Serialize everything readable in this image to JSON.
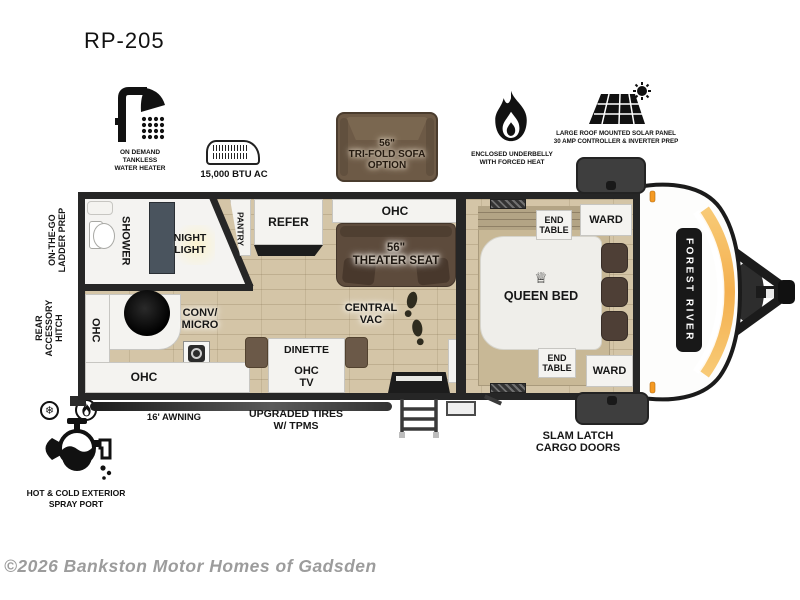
{
  "title": "RP-205",
  "features": {
    "water_heater": "ON DEMAND\nTANKLESS\nWATER HEATER",
    "ac": "15,000 BTU AC",
    "sofa": "56\"\nTRI-FOLD SOFA\nOPTION",
    "underbelly": "ENCLOSED UNDERBELLY\nWITH FORCED HEAT",
    "solar": "LARGE ROOF MOUNTED SOLAR PANEL\n30 AMP CONTROLLER & INVERTER PREP"
  },
  "plan": {
    "shower": "SHOWER",
    "night_light": "NIGHT\nLIGHT",
    "pantry": "PANTRY",
    "refer": "REFER",
    "ohc_galley": "OHC",
    "theater_seat": "56\"\nTHEATER SEAT",
    "central_vac": "CENTRAL\nVAC",
    "ohc_rear": "OHC",
    "conv_micro": "CONV/\nMICRO",
    "dinette": "DINETTE",
    "ohc_tv": "OHC\nTV",
    "ohc_kitchen": "OHC",
    "queen_bed": "QUEEN BED",
    "end_table_top": "END\nTABLE",
    "ward_top": "WARD",
    "end_table_bottom": "END\nTABLE",
    "ward_bottom": "WARD",
    "brand": "FOREST RIVER"
  },
  "exterior": {
    "ladder_prep": "ON-THE-GO\nLADDER PREP",
    "rear_hitch": "REAR\nACCESSORY\nHITCH",
    "awning": "16' AWNING",
    "tires": "UPGRADED TIRES\nW/ TPMS",
    "cargo_doors": "SLAM LATCH\nCARGO DOORS",
    "spray_port": "HOT & COLD EXTERIOR\nSPRAY PORT"
  },
  "icons": {
    "crown": "♕",
    "snowflake": "❄"
  },
  "watermark": "©2026 Bankston Motor Homes of Gadsden",
  "colors": {
    "accent_orange": "#f5a63a",
    "wall": "#262626",
    "floor_wood": "#d4c5a7",
    "sofa_brown": "#6d5a46",
    "seat_brown": "#5d4b3c",
    "watermark_gray": "#9c9c9c"
  }
}
